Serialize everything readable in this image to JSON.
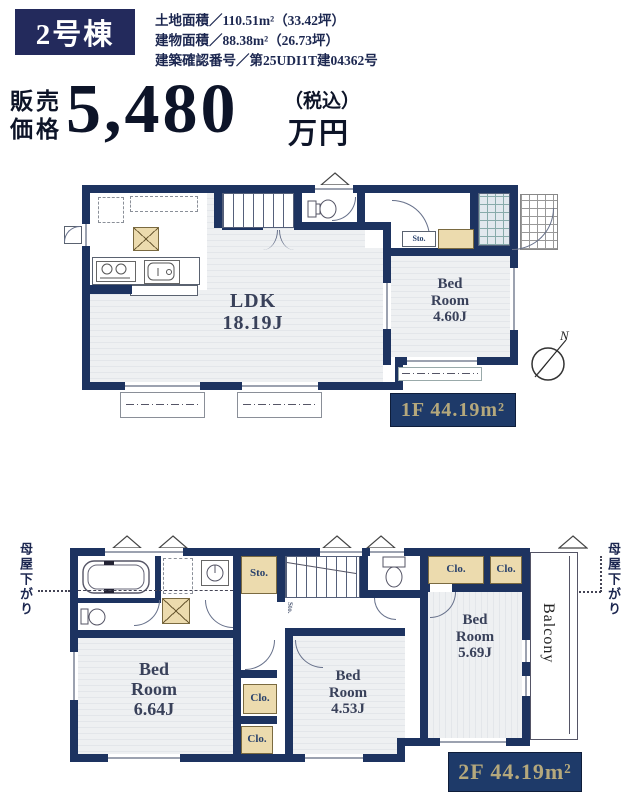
{
  "header": {
    "building_badge": "2号棟",
    "specs": [
      "土地面積／110.51m²（33.42坪）",
      "建物面積／88.38m²（26.73坪）",
      "建築確認番号／第25UDI1T建04362号"
    ],
    "price": {
      "label1": "販売",
      "label2": "価格",
      "amount": "5,480",
      "tax": "（税込）",
      "unit": "万円"
    }
  },
  "floor1": {
    "badge": "1F 44.19m²",
    "ldk_name": "LDK",
    "ldk_size": "18.19J",
    "bed_name1": "Bed",
    "bed_name2": "Room",
    "bed_size": "4.60J",
    "storage": "Sto."
  },
  "floor2": {
    "badge": "2F 44.19m²",
    "bed1_name1": "Bed",
    "bed1_name2": "Room",
    "bed1_size": "6.64J",
    "bed2_name1": "Bed",
    "bed2_name2": "Room",
    "bed2_size": "4.53J",
    "bed3_name1": "Bed",
    "bed3_name2": "Room",
    "bed3_size": "5.69J",
    "storage_top": "Sto.",
    "storage_understairs": "Sto.",
    "closet_top1": "Clo.",
    "closet_top2": "Clo.",
    "closet_mid1": "Clo.",
    "closet_mid2": "Clo.",
    "balcony": "Balcony",
    "roof_note_left": "母屋下がり",
    "roof_note_right": "母屋下がり"
  },
  "compass": {
    "north": "N"
  },
  "colors": {
    "wall_navy": "#1d3360",
    "header_navy": "#232a5c",
    "badge_navy": "#1e3a69",
    "accent_gold": "#b5a87c",
    "beige": "#ecdbae"
  }
}
